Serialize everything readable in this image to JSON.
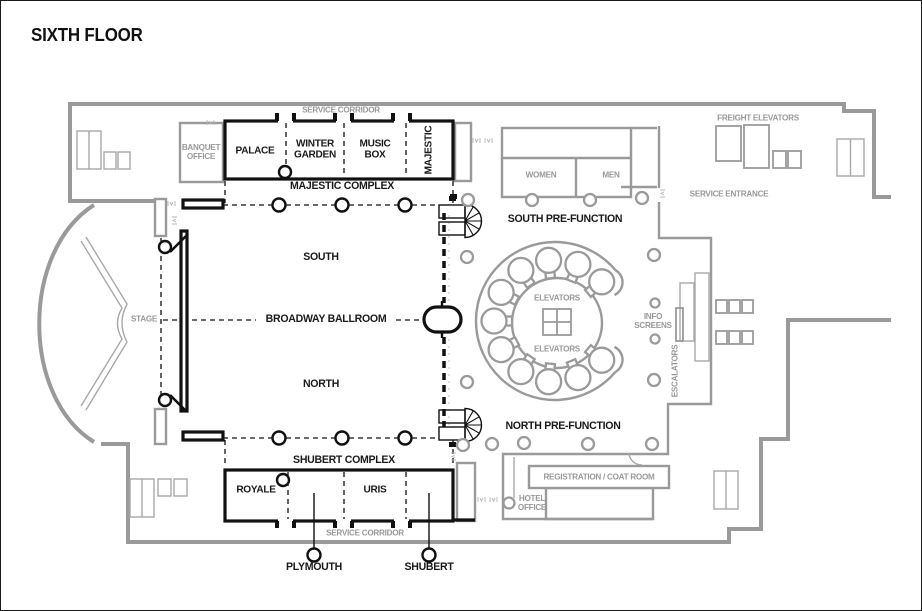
{
  "title": "SIXTH FLOOR",
  "majestic_complex": {
    "name": "MAJESTIC COMPLEX",
    "rooms": [
      "PALACE",
      "WINTER GARDEN",
      "MUSIC BOX",
      "MAJESTIC"
    ]
  },
  "shubert_complex": {
    "name": "SHUBERT COMPLEX",
    "rooms": [
      "ROYALE",
      "PLYMOUTH",
      "URIS",
      "SHUBERT"
    ]
  },
  "ballroom": {
    "name": "BROADWAY BALLROOM",
    "south": "SOUTH",
    "north": "NORTH",
    "stage": "STAGE",
    "south_prefunction": "SOUTH PRE-FUNCTION",
    "north_prefunction": "NORTH PRE-FUNCTION"
  },
  "facilities": {
    "service_corridor_top": "SERVICE CORRIDOR",
    "service_corridor_bottom": "SERVICE CORRIDOR",
    "banquet_office": "BANQUET OFFICE",
    "women": "WOMEN",
    "men": "MEN",
    "freight_elevators": "FREIGHT ELEVATORS",
    "service_entrance": "SERVICE ENTRANCE",
    "elevators_top": "ELEVATORS",
    "elevators_bottom": "ELEVATORS",
    "info_screens": "INFO SCREENS",
    "escalators": "ESCALATORS",
    "registration_coat_room": "REGISTRATION / COAT ROOM",
    "hotel_office": "HOTEL OFFICE"
  },
  "colors": {
    "wall_gray": "#9a9a9a",
    "wall_black": "#1a1a1a",
    "text_gray": "#9a9a9a",
    "text_black": "#1a1a1a",
    "background": "#ffffff"
  }
}
